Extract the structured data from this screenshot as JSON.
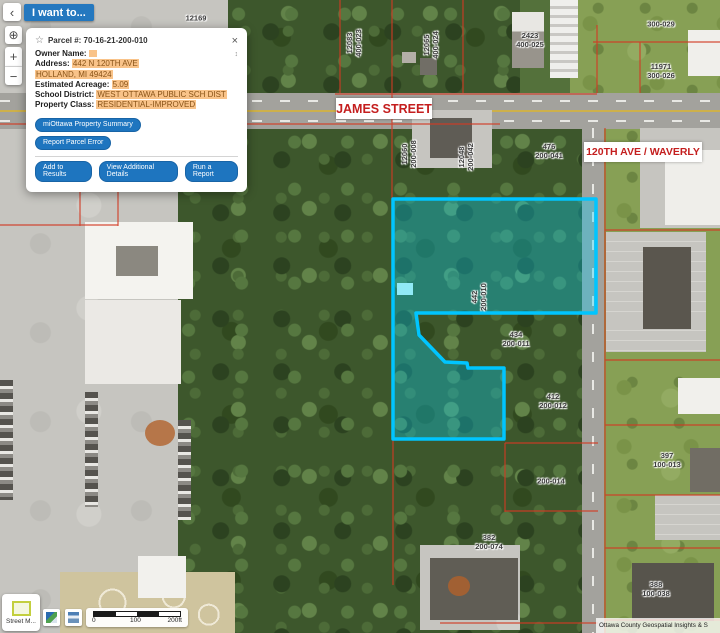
{
  "controls": {
    "collapse": "‹",
    "i_want_to": "I want to...",
    "locate_icon": "⊕",
    "zoom_in": "+",
    "zoom_out": "−"
  },
  "popup": {
    "star_icon": "☆",
    "title": "Parcel #: 70-16-21-200-010",
    "close_icon": "×",
    "scroll_icon": "↕",
    "rows": [
      {
        "label": "Owner Name:",
        "value": ""
      },
      {
        "label": "Address:",
        "value": "442 N 120TH AVE"
      },
      {
        "label": "",
        "value": "HOLLAND, MI 49424"
      },
      {
        "label": "Estimated Acreage:",
        "value": "5.09"
      },
      {
        "label": "School District:",
        "value": "WEST OTTAWA PUBLIC SCH DIST"
      },
      {
        "label": "Property Class:",
        "value": "RESIDENTIAL-IMPROVED"
      }
    ],
    "buttons": {
      "summary": "miOttawa Property Summary",
      "report_error": "Report Parcel Error",
      "add_results": "Add to Results",
      "view_details": "View Additional Details",
      "run_report": "Run a Report"
    }
  },
  "map": {
    "street_labels": [
      {
        "text": "JAMES STREET"
      },
      {
        "text": "120TH AVE / WAVERLY"
      }
    ],
    "parcel_labels": [
      {
        "line1": "12169"
      },
      {
        "line1": "12083",
        "line2": "400-023"
      },
      {
        "line1": "12065",
        "line2": "400-024"
      },
      {
        "line1": "2423",
        "line2": "400-025"
      },
      {
        "line1": "300-029"
      },
      {
        "line1": "11971",
        "line2": "300-026"
      },
      {
        "line1": "12060",
        "line2": "200-008"
      },
      {
        "line1": "12048",
        "line2": "200-042"
      },
      {
        "line1": "476",
        "line2": "200-041"
      },
      {
        "line1": "442",
        "line2": "200-010"
      },
      {
        "line1": "434",
        "line2": "200-011"
      },
      {
        "line1": "412",
        "line2": "200-012"
      },
      {
        "line1": "200-014"
      },
      {
        "line1": "397",
        "line2": "100-013"
      },
      {
        "line1": "382",
        "line2": "200-074"
      },
      {
        "line1": "388",
        "line2": "100-038"
      }
    ],
    "selected_parcel": "70-16-21-200-010"
  },
  "footer": {
    "basemap_label": "Street M...",
    "scale": {
      "start": "0",
      "mid": "100",
      "end": "200ft"
    },
    "attribution": "Ottawa County Geospatial Insights & S"
  },
  "colors": {
    "highlight_stroke": "#00c5ff",
    "highlight_fill": "rgba(0,213,255,0.33)",
    "parcel_line": "#d23b24",
    "street_label_red": "#c41e1e",
    "button_blue": "#1e75bf",
    "value_highlight_bg": "#f9c389"
  }
}
